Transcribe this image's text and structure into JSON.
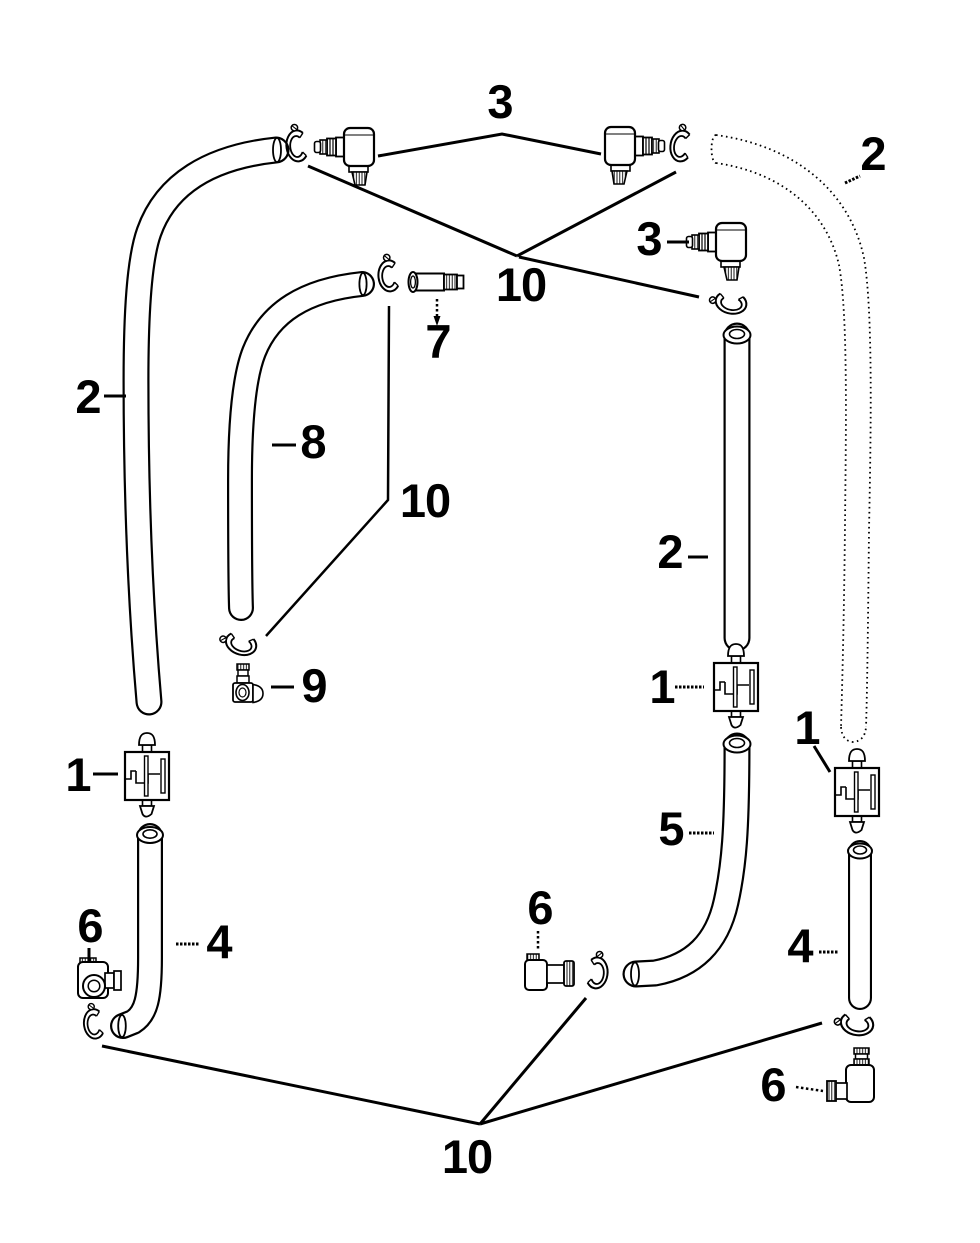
{
  "page": {
    "background_color": "#ffffff",
    "line_color": "#000000",
    "text_color": "#000000"
  },
  "diagram": {
    "type": "exploded-parts-diagram",
    "description_of_pixels": "black line-art hose and fitting assembly diagram with numbered callouts",
    "callouts": [
      {
        "id": "3-top",
        "label": "3",
        "x": 500,
        "y": 101
      },
      {
        "id": "2-top-right",
        "label": "2",
        "x": 873,
        "y": 153
      },
      {
        "id": "3-right",
        "label": "3",
        "x": 649,
        "y": 238
      },
      {
        "id": "10-top",
        "label": "10",
        "x": 521,
        "y": 284
      },
      {
        "id": "7",
        "label": "7",
        "x": 438,
        "y": 341
      },
      {
        "id": "2-left",
        "label": "2",
        "x": 88,
        "y": 396
      },
      {
        "id": "8",
        "label": "8",
        "x": 313,
        "y": 441
      },
      {
        "id": "10-middle",
        "label": "10",
        "x": 425,
        "y": 500
      },
      {
        "id": "2-middle-right",
        "label": "2",
        "x": 670,
        "y": 551
      },
      {
        "id": "9",
        "label": "9",
        "x": 314,
        "y": 685
      },
      {
        "id": "1-middle-right",
        "label": "1",
        "x": 662,
        "y": 686
      },
      {
        "id": "1-far-right",
        "label": "1",
        "x": 807,
        "y": 727
      },
      {
        "id": "1-left",
        "label": "1",
        "x": 78,
        "y": 774
      },
      {
        "id": "5",
        "label": "5",
        "x": 671,
        "y": 828
      },
      {
        "id": "6-middle",
        "label": "6",
        "x": 540,
        "y": 907
      },
      {
        "id": "6-left",
        "label": "6",
        "x": 90,
        "y": 925
      },
      {
        "id": "4-left",
        "label": "4",
        "x": 219,
        "y": 941
      },
      {
        "id": "4-right",
        "label": "4",
        "x": 800,
        "y": 945
      },
      {
        "id": "6-bottom-right",
        "label": "6",
        "x": 773,
        "y": 1084
      },
      {
        "id": "10-bottom",
        "label": "10",
        "x": 467,
        "y": 1156
      }
    ]
  }
}
